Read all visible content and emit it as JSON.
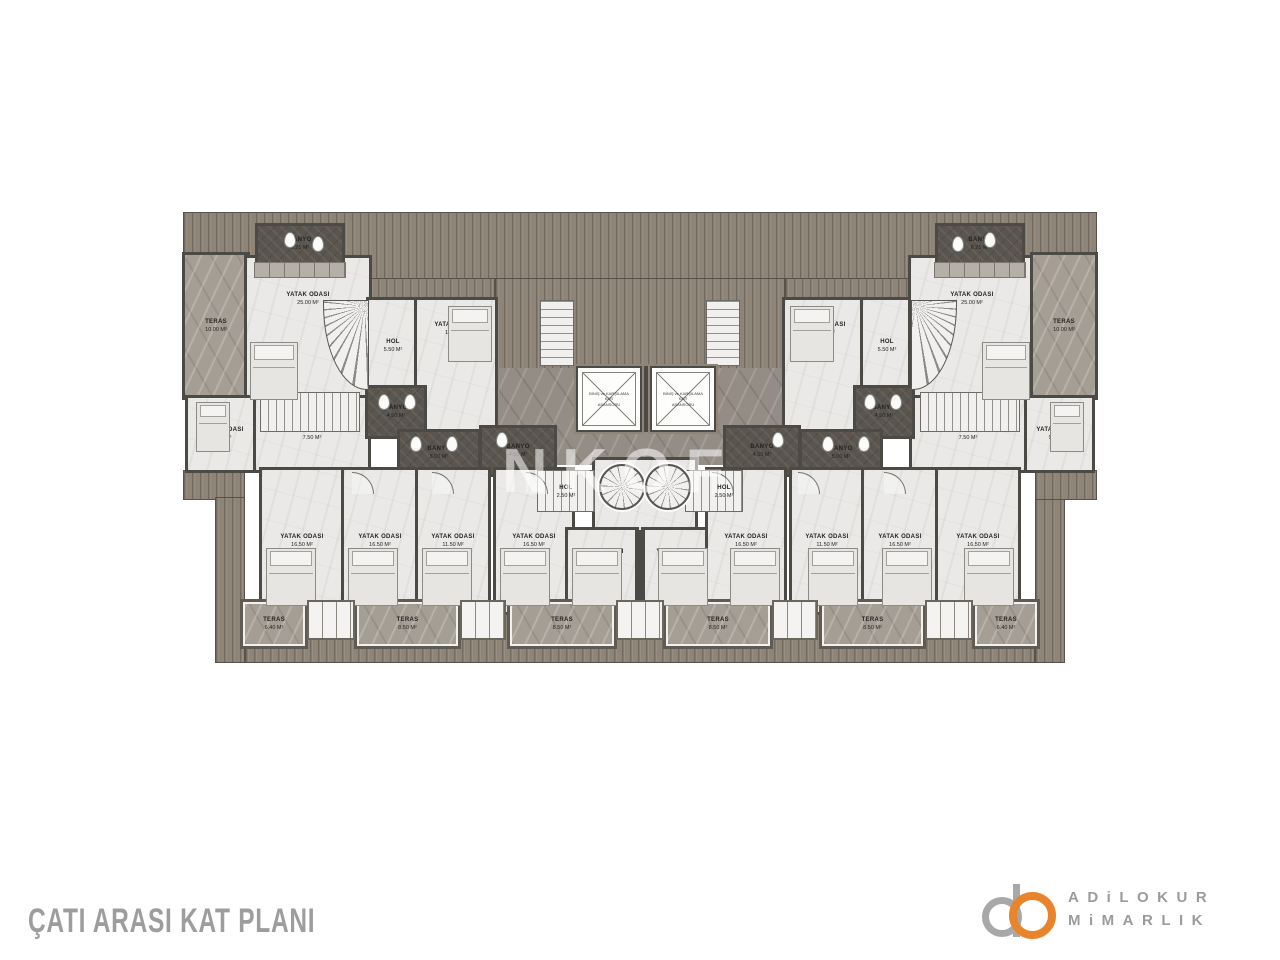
{
  "title": "ÇATI ARASI KAT PLANI",
  "watermark": "NKOF",
  "brand": {
    "line1": "ADiLOKUR",
    "line2": "MiMARLIK",
    "accent_color": "#E8842C",
    "text_color": "#9B9B9B"
  },
  "colors": {
    "roof": "#8E8578",
    "wall": "#4C4A45",
    "floor_light": "#EAE9E7",
    "floor_marble": "#A59E95",
    "tile_dark": "#5B554F",
    "title_text": "#9D9D9D"
  },
  "plan": {
    "elevator_text": [
      "BİNİŞ ve KARŞILAMA",
      "KATI",
      "ASANSÖRÜ"
    ],
    "roof": [
      [
        183,
        212,
        914,
        68
      ],
      [
        369,
        278,
        126,
        22
      ],
      [
        785,
        278,
        126,
        22
      ],
      [
        495,
        278,
        290,
        92
      ],
      [
        183,
        470,
        62,
        30
      ],
      [
        215,
        497,
        30,
        166
      ],
      [
        245,
        600,
        790,
        63
      ],
      [
        1035,
        497,
        30,
        166
      ],
      [
        1035,
        470,
        62,
        30
      ]
    ],
    "rooms": [
      {
        "id": "core-corridor",
        "label": null,
        "area": null,
        "cls": "marble-dark",
        "r": [
          455,
          368,
          370,
          97
        ]
      },
      {
        "id": "center-stair-hall",
        "label": null,
        "area": null,
        "cls": "room light",
        "r": [
          595,
          460,
          100,
          72
        ]
      },
      {
        "id": "teras-left",
        "label": "TERAS",
        "area": "10.00 M²",
        "cls": "room marble",
        "r": [
          185,
          255,
          62,
          142
        ]
      },
      {
        "id": "master-bedroom-left",
        "label": "YATAK ODASI",
        "area": "25.00 M²",
        "cls": "room light lt",
        "r": [
          247,
          258,
          122,
          174
        ]
      },
      {
        "id": "banyo-top-left",
        "label": "BANYO",
        "area": "6.25 M²",
        "cls": "room dark",
        "r": [
          258,
          226,
          84,
          36
        ]
      },
      {
        "id": "hol-top-left",
        "label": "HOL",
        "area": "5.50 M²",
        "cls": "room light",
        "r": [
          369,
          300,
          48,
          92
        ]
      },
      {
        "id": "bedroom-inner-left",
        "label": "YATAK ODASI",
        "area": "16.50 M²",
        "cls": "room light lt",
        "r": [
          417,
          300,
          78,
          132
        ]
      },
      {
        "id": "bedroom-small-left",
        "label": "YATAK ODASI",
        "area": "9.50 M²",
        "cls": "room light",
        "r": [
          188,
          398,
          68,
          72
        ]
      },
      {
        "id": "hol-lower-left",
        "label": "HOL",
        "area": "7.50 M²",
        "cls": "room light",
        "r": [
          256,
          398,
          112,
          72
        ]
      },
      {
        "id": "banyo-left-a",
        "label": "BANYO",
        "area": "4.50 M²",
        "cls": "room dark",
        "r": [
          368,
          388,
          56,
          48
        ]
      },
      {
        "id": "banyo-left-b",
        "label": "BANYO",
        "area": "5.00 M²",
        "cls": "room dark",
        "r": [
          400,
          432,
          78,
          42
        ]
      },
      {
        "id": "banyo-left-c",
        "label": "BANYO",
        "area": "4.50 M²",
        "cls": "room dark",
        "r": [
          482,
          428,
          72,
          46
        ]
      },
      {
        "id": "bedroom-inner-right",
        "label": "YATAK ODASI",
        "area": "16.50 M²",
        "cls": "room light lt",
        "r": [
          785,
          300,
          78,
          132
        ]
      },
      {
        "id": "hol-top-right",
        "label": "HOL",
        "area": "5.50 M²",
        "cls": "room light",
        "r": [
          863,
          300,
          48,
          92
        ]
      },
      {
        "id": "master-bedroom-right",
        "label": "YATAK ODASI",
        "area": "25.00 M²",
        "cls": "room light lt",
        "r": [
          911,
          258,
          122,
          174
        ]
      },
      {
        "id": "teras-right",
        "label": "TERAS",
        "area": "10.00 M²",
        "cls": "room marble",
        "r": [
          1033,
          255,
          62,
          142
        ]
      },
      {
        "id": "banyo-top-right",
        "label": "BANYO",
        "area": "6.25 M²",
        "cls": "room dark",
        "r": [
          938,
          226,
          84,
          36
        ]
      },
      {
        "id": "bedroom-small-right",
        "label": "YATAK ODASI",
        "area": "9.50 M²",
        "cls": "room light",
        "r": [
          1024,
          398,
          68,
          72
        ]
      },
      {
        "id": "hol-lower-right",
        "label": "HOL",
        "area": "7.50 M²",
        "cls": "room light",
        "r": [
          912,
          398,
          112,
          72
        ]
      },
      {
        "id": "banyo-right-a",
        "label": "BANYO",
        "area": "4.50 M²",
        "cls": "room dark",
        "r": [
          856,
          388,
          56,
          48
        ]
      },
      {
        "id": "banyo-right-b",
        "label": "BANYO",
        "area": "5.00 M²",
        "cls": "room dark",
        "r": [
          802,
          432,
          78,
          42
        ]
      },
      {
        "id": "banyo-right-c",
        "label": "BANYO",
        "area": "4.50 M²",
        "cls": "room dark",
        "r": [
          726,
          428,
          72,
          46
        ]
      },
      {
        "id": "bedroom-b1",
        "label": "YATAK ODASI",
        "area": "16.50 M²",
        "cls": "room light",
        "r": [
          262,
          470,
          80,
          142
        ]
      },
      {
        "id": "bedroom-b2",
        "label": "YATAK ODASI",
        "area": "16.50 M²",
        "cls": "room light",
        "r": [
          344,
          470,
          72,
          142
        ]
      },
      {
        "id": "bedroom-b3",
        "label": "YATAK ODASI",
        "area": "11.50 M²",
        "cls": "room light",
        "r": [
          418,
          470,
          70,
          142
        ]
      },
      {
        "id": "bedroom-b4",
        "label": "YATAK ODASI",
        "area": "16.50 M²",
        "cls": "room light",
        "r": [
          496,
          470,
          76,
          142
        ]
      },
      {
        "id": "bedroom-b5",
        "label": "YATAK ODASI",
        "area": "11.50 M²",
        "cls": "room light lt",
        "r": [
          568,
          530,
          68,
          82
        ]
      },
      {
        "id": "bedroom-b6",
        "label": "YATAK ODASI",
        "area": "11.50 M²",
        "cls": "room light lt",
        "r": [
          644,
          530,
          68,
          82
        ]
      },
      {
        "id": "bedroom-b7",
        "label": "YATAK ODASI",
        "area": "16.50 M²",
        "cls": "room light",
        "r": [
          708,
          470,
          76,
          142
        ]
      },
      {
        "id": "bedroom-b8",
        "label": "YATAK ODASI",
        "area": "11.50 M²",
        "cls": "room light",
        "r": [
          792,
          470,
          70,
          142
        ]
      },
      {
        "id": "bedroom-b9",
        "label": "YATAK ODASI",
        "area": "16.50 M²",
        "cls": "room light",
        "r": [
          864,
          470,
          72,
          142
        ]
      },
      {
        "id": "bedroom-b10",
        "label": "YATAK ODASI",
        "area": "16.50 M²",
        "cls": "room light",
        "r": [
          938,
          470,
          80,
          142
        ]
      },
      {
        "id": "teras-b1",
        "label": "TERAS",
        "area": "6.40 M²",
        "cls": "room terrace marble",
        "r": [
          243,
          602,
          62,
          44
        ]
      },
      {
        "id": "teras-b2",
        "label": "TERAS",
        "area": "8.50 M²",
        "cls": "room terrace marble",
        "r": [
          357,
          602,
          101,
          44
        ]
      },
      {
        "id": "teras-b3",
        "label": "TERAS",
        "area": "8.50 M²",
        "cls": "room terrace marble",
        "r": [
          510,
          602,
          104,
          44
        ]
      },
      {
        "id": "teras-b4",
        "label": "TERAS",
        "area": "8.50 M²",
        "cls": "room terrace marble",
        "r": [
          666,
          602,
          104,
          44
        ]
      },
      {
        "id": "teras-b5",
        "label": "TERAS",
        "area": "8.50 M²",
        "cls": "room terrace marble",
        "r": [
          822,
          602,
          101,
          44
        ]
      },
      {
        "id": "teras-b6",
        "label": "TERAS",
        "area": "6.40 M²",
        "cls": "room terrace marble",
        "r": [
          975,
          602,
          62,
          44
        ]
      }
    ],
    "fixtures": [
      {
        "t": "stair-h",
        "r": [
          260,
          392,
          100,
          40
        ]
      },
      {
        "t": "stair-h",
        "r": [
          920,
          392,
          100,
          40
        ]
      },
      {
        "t": "curve-l",
        "r": [
          323,
          300,
          46,
          90
        ]
      },
      {
        "t": "curve-r",
        "r": [
          911,
          300,
          46,
          90
        ]
      },
      {
        "t": "stair-v",
        "r": [
          540,
          300,
          34,
          66
        ]
      },
      {
        "t": "stair-v",
        "r": [
          706,
          300,
          34,
          66
        ]
      },
      {
        "t": "stair-h",
        "r": [
          537,
          470,
          58,
          42
        ]
      },
      {
        "t": "stair-h",
        "r": [
          685,
          470,
          58,
          42
        ]
      },
      {
        "t": "spiral",
        "r": [
          599,
          464,
          46,
          46
        ]
      },
      {
        "t": "spiral",
        "r": [
          645,
          464,
          46,
          46
        ]
      },
      {
        "t": "wall",
        "r": [
          642,
          366,
          8,
          66
        ]
      },
      {
        "t": "wall",
        "r": [
          635,
          530,
          10,
          82
        ]
      },
      {
        "t": "elevator",
        "r": [
          576,
          366,
          66,
          66
        ]
      },
      {
        "t": "elevator",
        "r": [
          650,
          366,
          66,
          66
        ]
      },
      {
        "t": "wardrobe",
        "r": [
          254,
          262,
          92,
          16
        ]
      },
      {
        "t": "wardrobe",
        "r": [
          934,
          262,
          92,
          16
        ]
      },
      {
        "t": "bed",
        "r": [
          250,
          342,
          48,
          58
        ]
      },
      {
        "t": "bed",
        "r": [
          982,
          342,
          48,
          58
        ]
      },
      {
        "t": "bed",
        "r": [
          448,
          306,
          44,
          56
        ]
      },
      {
        "t": "bed",
        "r": [
          790,
          306,
          44,
          56
        ]
      },
      {
        "t": "bed",
        "r": [
          196,
          402,
          34,
          50
        ]
      },
      {
        "t": "bed",
        "r": [
          1050,
          402,
          34,
          50
        ]
      },
      {
        "t": "bed",
        "r": [
          266,
          548,
          50,
          58
        ]
      },
      {
        "t": "bed",
        "r": [
          348,
          548,
          50,
          58
        ]
      },
      {
        "t": "bed",
        "r": [
          422,
          548,
          50,
          58
        ]
      },
      {
        "t": "bed",
        "r": [
          500,
          548,
          50,
          58
        ]
      },
      {
        "t": "bed",
        "r": [
          572,
          548,
          50,
          58
        ]
      },
      {
        "t": "bed",
        "r": [
          658,
          548,
          50,
          58
        ]
      },
      {
        "t": "bed",
        "r": [
          730,
          548,
          50,
          58
        ]
      },
      {
        "t": "bed",
        "r": [
          808,
          548,
          50,
          58
        ]
      },
      {
        "t": "bed",
        "r": [
          882,
          548,
          50,
          58
        ]
      },
      {
        "t": "bed",
        "r": [
          964,
          548,
          50,
          58
        ]
      },
      {
        "t": "wc",
        "r": [
          284,
          232,
          12,
          16
        ]
      },
      {
        "t": "wc",
        "r": [
          312,
          236,
          12,
          16
        ]
      },
      {
        "t": "wc",
        "r": [
          378,
          394,
          12,
          16
        ]
      },
      {
        "t": "wc",
        "r": [
          404,
          394,
          12,
          16
        ]
      },
      {
        "t": "wc",
        "r": [
          410,
          436,
          12,
          16
        ]
      },
      {
        "t": "wc",
        "r": [
          446,
          436,
          12,
          16
        ]
      },
      {
        "t": "wc",
        "r": [
          496,
          432,
          12,
          16
        ]
      },
      {
        "t": "wc",
        "r": [
          984,
          232,
          12,
          16
        ]
      },
      {
        "t": "wc",
        "r": [
          952,
          236,
          12,
          16
        ]
      },
      {
        "t": "wc",
        "r": [
          890,
          394,
          12,
          16
        ]
      },
      {
        "t": "wc",
        "r": [
          864,
          394,
          12,
          16
        ]
      },
      {
        "t": "wc",
        "r": [
          858,
          436,
          12,
          16
        ]
      },
      {
        "t": "wc",
        "r": [
          822,
          436,
          12,
          16
        ]
      },
      {
        "t": "wc",
        "r": [
          772,
          432,
          12,
          16
        ]
      },
      {
        "t": "bay",
        "r": [
          307,
          600,
          48,
          40
        ]
      },
      {
        "t": "bay",
        "r": [
          460,
          600,
          46,
          40
        ]
      },
      {
        "t": "bay",
        "r": [
          616,
          600,
          48,
          40
        ]
      },
      {
        "t": "bay",
        "r": [
          772,
          600,
          46,
          40
        ]
      },
      {
        "t": "bay",
        "r": [
          925,
          600,
          48,
          40
        ]
      },
      {
        "t": "arc",
        "r": [
          352,
          472,
          22,
          22
        ]
      },
      {
        "t": "arc",
        "r": [
          432,
          472,
          22,
          22
        ]
      },
      {
        "t": "arc",
        "r": [
          526,
          472,
          22,
          22
        ]
      },
      {
        "t": "arc",
        "r": [
          712,
          472,
          22,
          22
        ]
      },
      {
        "t": "arc",
        "r": [
          798,
          472,
          22,
          22
        ]
      },
      {
        "t": "arc",
        "r": [
          884,
          472,
          22,
          22
        ]
      }
    ],
    "overlay_labels": [
      {
        "id": "hol-center-left",
        "label": "HOL",
        "area": "2.50 M²",
        "cls": "",
        "r": [
          540,
          465,
          52,
          55
        ]
      },
      {
        "id": "hol-center-right",
        "label": "HOL",
        "area": "2.50 M²",
        "cls": "",
        "r": [
          698,
          465,
          52,
          55
        ]
      }
    ]
  }
}
